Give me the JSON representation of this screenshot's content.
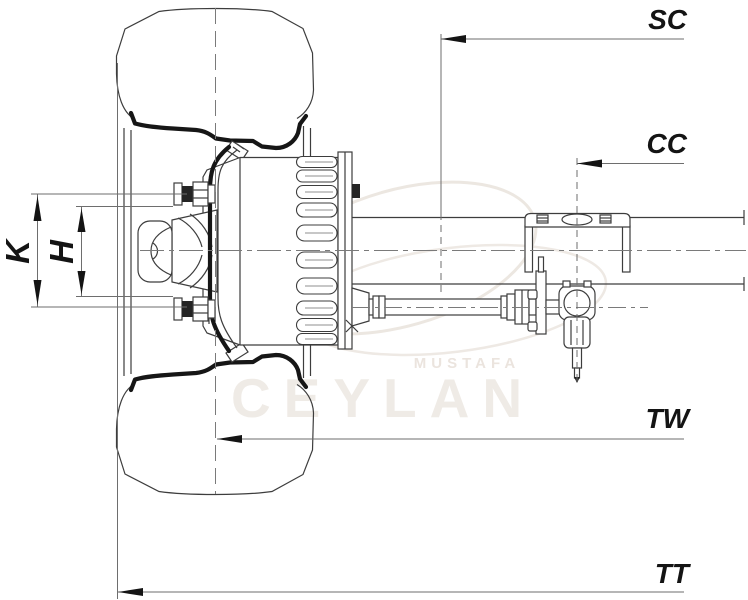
{
  "dimensions": {
    "sc": "SC",
    "cc": "CC",
    "tw": "TW",
    "tt": "TT",
    "k": "K",
    "h": "H"
  },
  "watermark": {
    "line1": "MUSTAFA",
    "line2": "CEYLAN"
  },
  "colors": {
    "background": "#ffffff",
    "drawing_line": "#3d3d3d",
    "thick_line": "#161616",
    "dimension_line": "#6e6e6e",
    "label": "#141414",
    "watermark": "#ece7e1"
  }
}
